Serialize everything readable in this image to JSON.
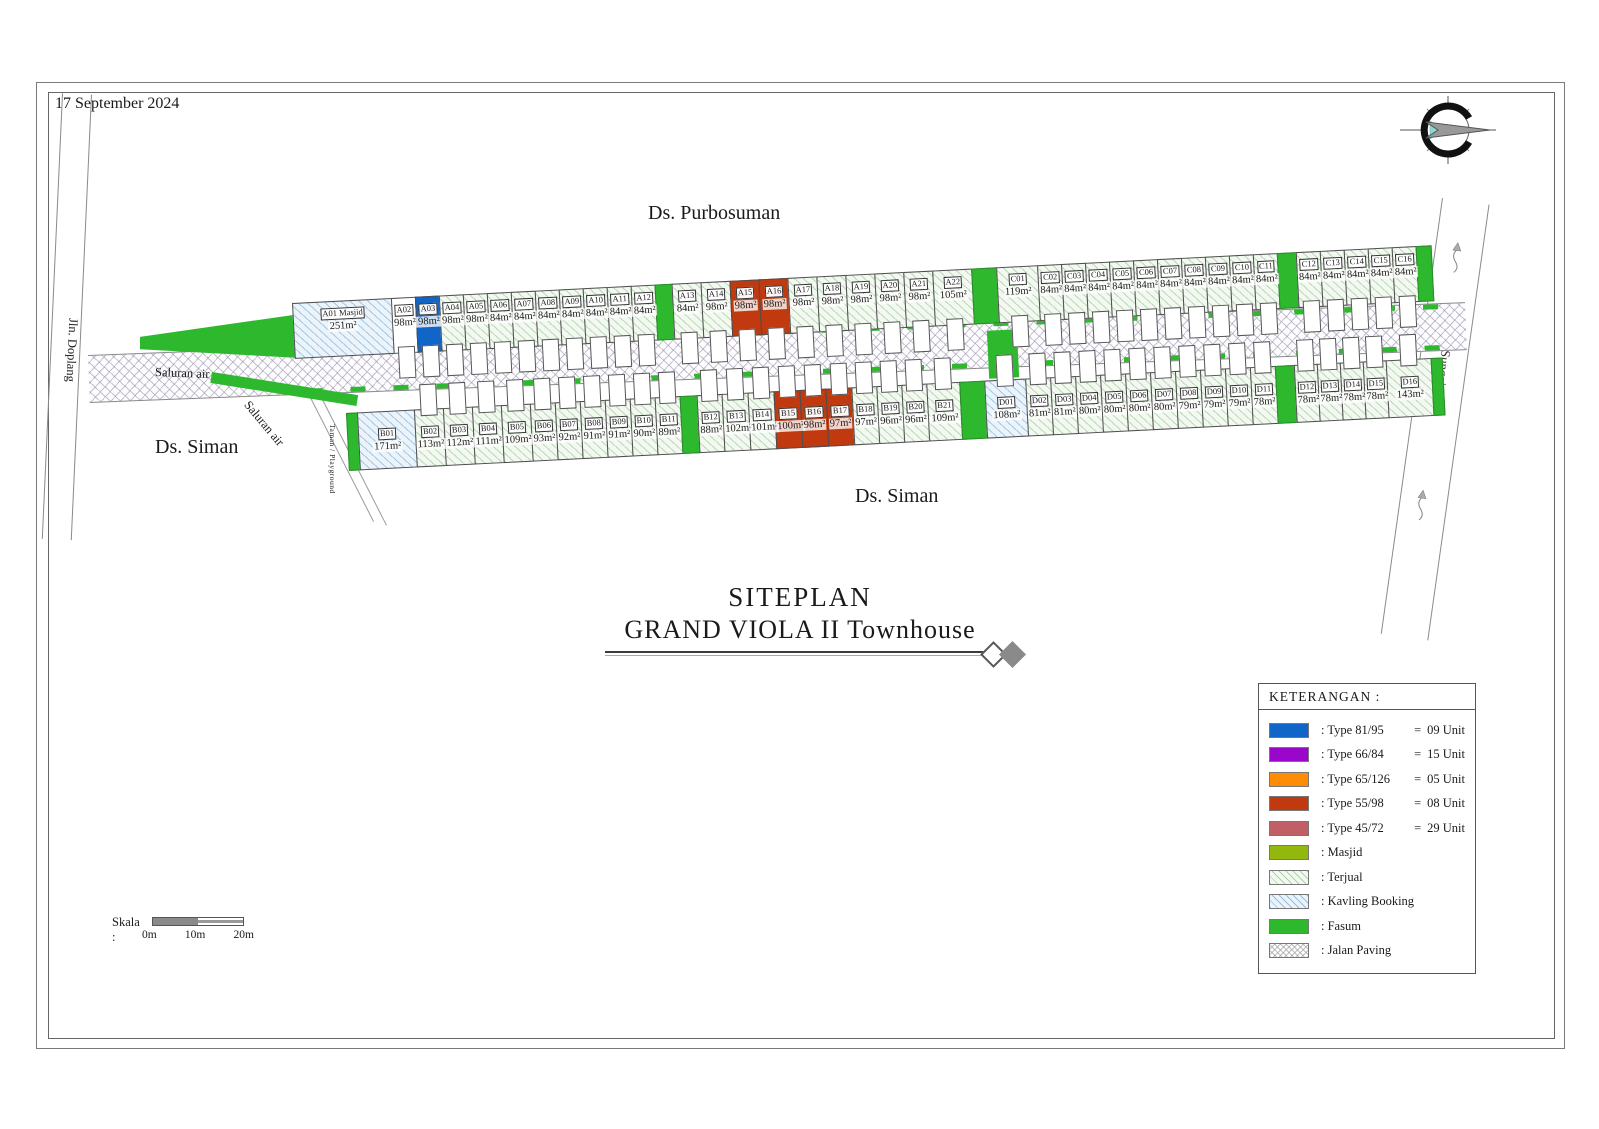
{
  "date": "17 September 2024",
  "labels": {
    "purbosuman": "Ds. Purbosuman",
    "siman_left": "Ds. Siman",
    "siman_bottom": "Ds. Siman",
    "doplang": "Jln. Doplang",
    "saluran_air_1": "Saluran air",
    "saluran_air_2": "Saluran air",
    "sungai": "Sungai",
    "taman": "Taman / Playground"
  },
  "title": {
    "line1": "SITEPLAN",
    "line2": "GRAND VIOLA II Townhouse"
  },
  "legend": {
    "header": "KETERANGAN  :",
    "items": [
      {
        "label": ": Type 81/95",
        "eq": "=",
        "value": "09 Unit",
        "color": "#1164c8",
        "swatch": "type-81-95"
      },
      {
        "label": ": Type 66/84",
        "eq": "=",
        "value": "15 Unit",
        "color": "#9b07ca",
        "swatch": "type-66-84"
      },
      {
        "label": ": Type 65/126",
        "eq": "=",
        "value": "05 Unit",
        "color": "#ff8c05",
        "swatch": "type-65-126"
      },
      {
        "label": ": Type 55/98",
        "eq": "=",
        "value": "08 Unit",
        "color": "#c0390f",
        "swatch": "type-55-98"
      },
      {
        "label": ": Type 45/72",
        "eq": "=",
        "value": "29 Unit",
        "color": "#c05f66",
        "swatch": "type-45-72"
      },
      {
        "label": ": Masjid",
        "color": "#92b80e",
        "swatch": "masjid"
      },
      {
        "label": ": Terjual",
        "pattern": "terjual",
        "swatch": "terjual"
      },
      {
        "label": ": Kavling Booking",
        "pattern": "booking",
        "swatch": "kavling-booking"
      },
      {
        "label": ": Fasum",
        "color": "#2eb82e",
        "swatch": "fasum"
      },
      {
        "label": ": Jalan Paving",
        "pattern": "paving",
        "swatch": "jalan-paving"
      }
    ]
  },
  "scale": {
    "label": "Skala  :",
    "ticks": [
      "0m",
      "10m",
      "20m"
    ]
  },
  "site": {
    "top_row": [
      {
        "id": "A01 Masjid",
        "area": "251m²",
        "w": 100,
        "s": "booking",
        "h": false
      },
      {
        "id": "A02",
        "area": "98m²",
        "w": 25,
        "s": "white"
      },
      {
        "id": "A03",
        "area": "98m²",
        "w": 25,
        "s": "blue"
      },
      {
        "id": "A04",
        "area": "98m²",
        "w": 25
      },
      {
        "id": "A05",
        "area": "98m²",
        "w": 25
      },
      {
        "id": "A06",
        "area": "84m²",
        "w": 25
      },
      {
        "id": "A07",
        "area": "84m²",
        "w": 25
      },
      {
        "id": "A08",
        "area": "84m²",
        "w": 25
      },
      {
        "id": "A09",
        "area": "84m²",
        "w": 25
      },
      {
        "id": "A10",
        "area": "84m²",
        "w": 25
      },
      {
        "id": "A11",
        "area": "84m²",
        "w": 25
      },
      {
        "id": "A12",
        "area": "84m²",
        "w": 25
      },
      {
        "s": "fasum",
        "w": 18
      },
      {
        "id": "A13",
        "area": "84m²",
        "w": 30
      },
      {
        "id": "A14",
        "area": "98m²",
        "w": 30
      },
      {
        "id": "A15",
        "area": "98m²",
        "w": 30,
        "s": "red"
      },
      {
        "id": "A16",
        "area": "98m²",
        "w": 30,
        "s": "red"
      },
      {
        "id": "A17",
        "area": "98m²",
        "w": 30
      },
      {
        "id": "A18",
        "area": "98m²",
        "w": 30
      },
      {
        "id": "A19",
        "area": "98m²",
        "w": 30
      },
      {
        "id": "A20",
        "area": "98m²",
        "w": 30
      },
      {
        "id": "A21",
        "area": "98m²",
        "w": 30
      },
      {
        "id": "A22",
        "area": "105m²",
        "w": 40
      },
      {
        "s": "fasum",
        "w": 26
      },
      {
        "id": "C01",
        "area": "119m²",
        "w": 42
      },
      {
        "id": "C02",
        "area": "84m²",
        "w": 25
      },
      {
        "id": "C03",
        "area": "84m²",
        "w": 25
      },
      {
        "id": "C04",
        "area": "84m²",
        "w": 25
      },
      {
        "id": "C05",
        "area": "84m²",
        "w": 25
      },
      {
        "id": "C06",
        "area": "84m²",
        "w": 25
      },
      {
        "id": "C07",
        "area": "84m²",
        "w": 25
      },
      {
        "id": "C08",
        "area": "84m²",
        "w": 25
      },
      {
        "id": "C09",
        "area": "84m²",
        "w": 25
      },
      {
        "id": "C10",
        "area": "84m²",
        "w": 25
      },
      {
        "id": "C11",
        "area": "84m²",
        "w": 25
      },
      {
        "s": "fasum",
        "w": 20
      },
      {
        "id": "C12",
        "area": "84m²",
        "w": 25
      },
      {
        "id": "C13",
        "area": "84m²",
        "w": 25
      },
      {
        "id": "C14",
        "area": "84m²",
        "w": 25
      },
      {
        "id": "C15",
        "area": "84m²",
        "w": 25
      },
      {
        "id": "C16",
        "area": "84m²",
        "w": 25
      },
      {
        "s": "fasum",
        "w": 16
      }
    ],
    "bottom_row": [
      {
        "s": "fasum",
        "w": 12
      },
      {
        "id": "B01",
        "area": "171m²",
        "w": 58,
        "s": "booking",
        "h": false
      },
      {
        "id": "B02",
        "area": "113m²",
        "w": 30
      },
      {
        "id": "B03",
        "area": "112m²",
        "w": 30
      },
      {
        "id": "B04",
        "area": "111m²",
        "w": 30
      },
      {
        "id": "B05",
        "area": "109m²",
        "w": 30
      },
      {
        "id": "B06",
        "area": "93m²",
        "w": 26
      },
      {
        "id": "B07",
        "area": "92m²",
        "w": 26
      },
      {
        "id": "B08",
        "area": "91m²",
        "w": 26
      },
      {
        "id": "B09",
        "area": "91m²",
        "w": 26
      },
      {
        "id": "B10",
        "area": "90m²",
        "w": 26
      },
      {
        "id": "B11",
        "area": "89m²",
        "w": 26
      },
      {
        "s": "fasum",
        "w": 18
      },
      {
        "id": "B12",
        "area": "88m²",
        "w": 26
      },
      {
        "id": "B13",
        "area": "102m²",
        "w": 27
      },
      {
        "id": "B14",
        "area": "101m²",
        "w": 27
      },
      {
        "id": "B15",
        "area": "100m²",
        "w": 27,
        "s": "red"
      },
      {
        "id": "B16",
        "area": "98m²",
        "w": 27,
        "s": "red"
      },
      {
        "id": "B17",
        "area": "97m²",
        "w": 27,
        "s": "red"
      },
      {
        "id": "B18",
        "area": "97m²",
        "w": 26
      },
      {
        "id": "B19",
        "area": "96m²",
        "w": 26
      },
      {
        "id": "B20",
        "area": "96m²",
        "w": 26
      },
      {
        "id": "B21",
        "area": "109m²",
        "w": 34
      },
      {
        "s": "fasum",
        "w": 26
      },
      {
        "id": "D01",
        "area": "108m²",
        "w": 42,
        "s": "booking"
      },
      {
        "id": "D02",
        "area": "81m²",
        "w": 26
      },
      {
        "id": "D03",
        "area": "81m²",
        "w": 26
      },
      {
        "id": "D04",
        "area": "80m²",
        "w": 26
      },
      {
        "id": "D05",
        "area": "80m²",
        "w": 26
      },
      {
        "id": "D06",
        "area": "80m²",
        "w": 26
      },
      {
        "id": "D07",
        "area": "80m²",
        "w": 26
      },
      {
        "id": "D08",
        "area": "79m²",
        "w": 26
      },
      {
        "id": "D09",
        "area": "79m²",
        "w": 26
      },
      {
        "id": "D10",
        "area": "79m²",
        "w": 26
      },
      {
        "id": "D11",
        "area": "78m²",
        "w": 26
      },
      {
        "s": "fasum",
        "w": 20
      },
      {
        "id": "D12",
        "area": "78m²",
        "w": 24
      },
      {
        "id": "D13",
        "area": "78m²",
        "w": 24
      },
      {
        "id": "D14",
        "area": "78m²",
        "w": 24
      },
      {
        "id": "D15",
        "area": "78m²",
        "w": 24
      },
      {
        "id": "D16",
        "area": "143m²",
        "w": 46
      },
      {
        "s": "fasum",
        "w": 12
      }
    ]
  }
}
